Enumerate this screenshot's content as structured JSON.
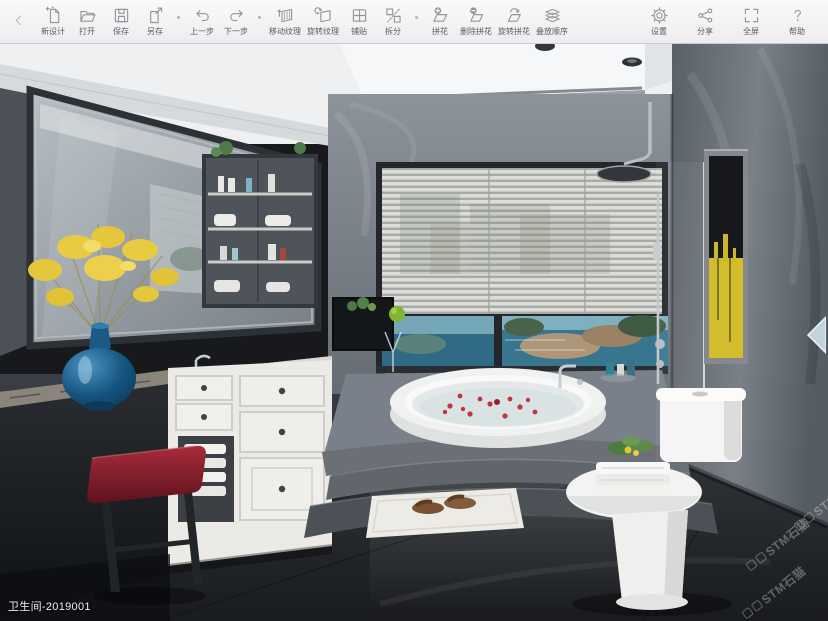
{
  "toolbar": {
    "groups": [
      {
        "items": [
          {
            "id": "new-design",
            "label": "新设计"
          },
          {
            "id": "open",
            "label": "打开"
          },
          {
            "id": "save",
            "label": "保存"
          },
          {
            "id": "save-as",
            "label": "另存"
          }
        ]
      },
      {
        "items": [
          {
            "id": "undo",
            "label": "上一步"
          },
          {
            "id": "redo",
            "label": "下一步"
          }
        ]
      },
      {
        "items": [
          {
            "id": "move-texture",
            "label": "移动纹理"
          },
          {
            "id": "rotate-texture",
            "label": "旋转纹理"
          },
          {
            "id": "pave",
            "label": "铺贴"
          },
          {
            "id": "split",
            "label": "拆分"
          }
        ]
      },
      {
        "items": [
          {
            "id": "parquet",
            "label": "拼花"
          },
          {
            "id": "delete-parquet",
            "label": "删除拼花"
          },
          {
            "id": "rotate-parquet",
            "label": "旋转拼花"
          },
          {
            "id": "stack-order",
            "label": "叠放顺序"
          }
        ]
      }
    ],
    "right_items": [
      {
        "id": "settings",
        "label": "设置"
      },
      {
        "id": "share",
        "label": "分享"
      },
      {
        "id": "fullscreen",
        "label": "全屏"
      },
      {
        "id": "help",
        "label": "帮助"
      }
    ]
  },
  "canvas": {
    "design_label": "卫生间-2019001",
    "watermark_text": "STM石猫"
  },
  "colors": {
    "toolbar_icon": "#95959b",
    "toolbar_label": "#5c5c60",
    "watermark": "rgba(255,255,255,0.30)",
    "panel_arrow": "#c2d2df"
  }
}
